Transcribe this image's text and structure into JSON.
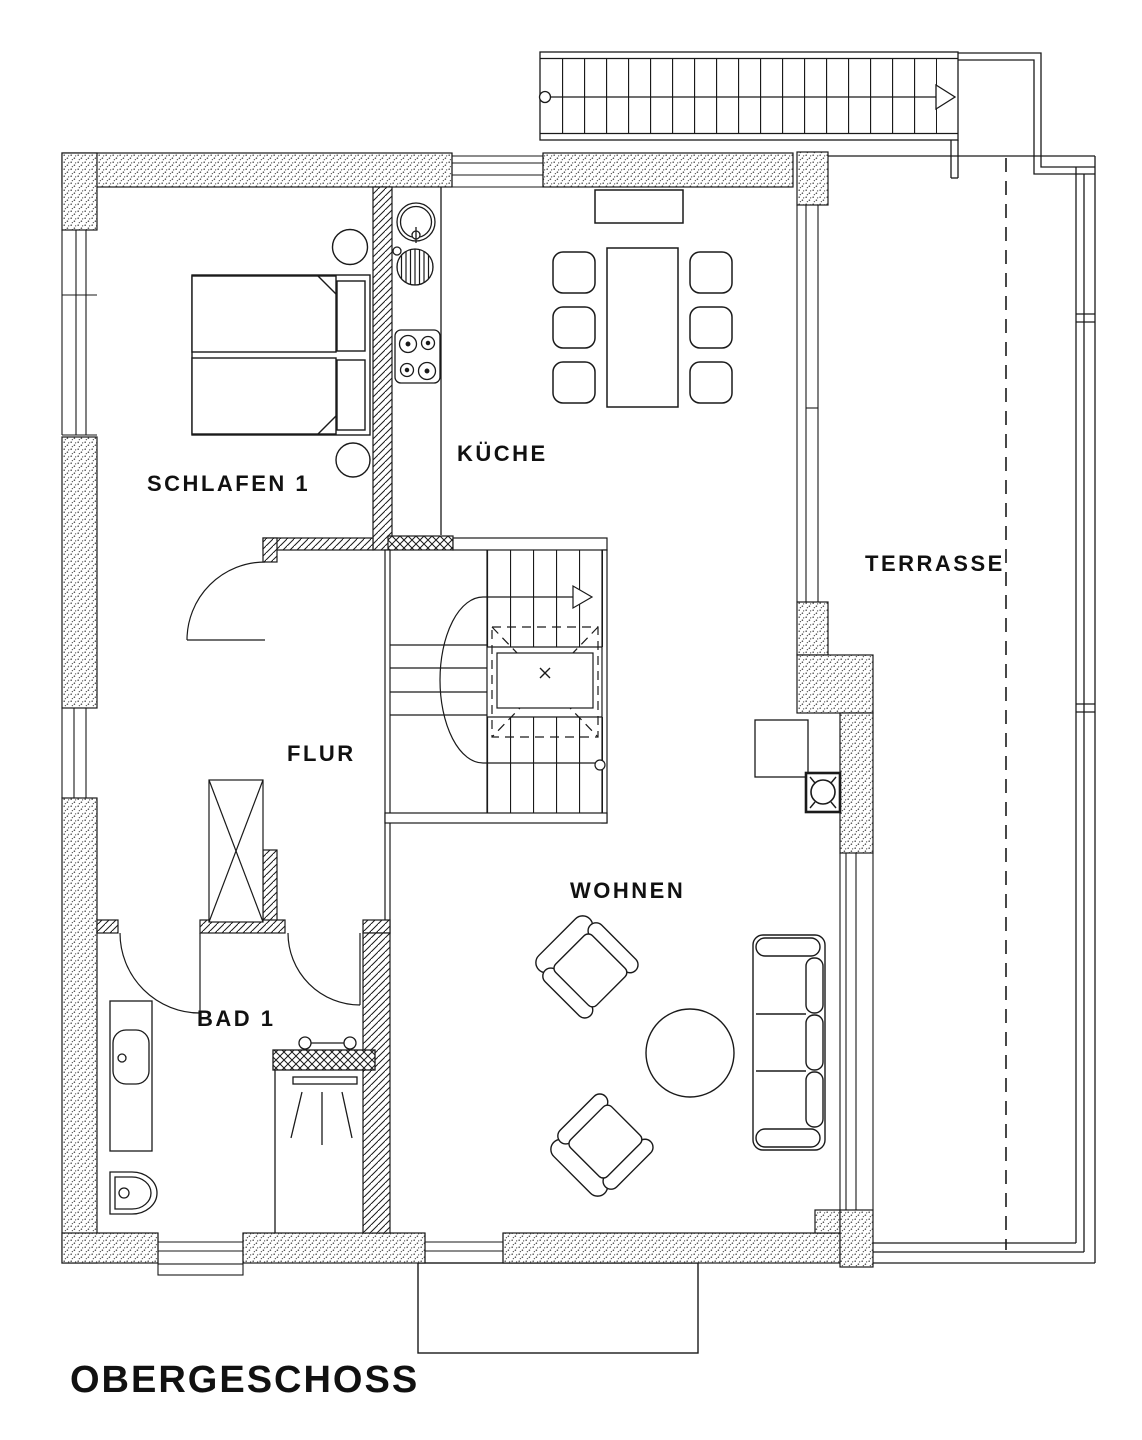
{
  "plan": {
    "floor_title": "OBERGESCHOSS",
    "rooms": [
      {
        "id": "schlafen-1",
        "label": "SCHLAFEN 1"
      },
      {
        "id": "kueche",
        "label": "KÜCHE"
      },
      {
        "id": "terrasse",
        "label": "TERRASSE"
      },
      {
        "id": "flur",
        "label": "FLUR"
      },
      {
        "id": "wohnen",
        "label": "WOHNEN"
      },
      {
        "id": "bad-1",
        "label": "BAD 1"
      }
    ],
    "colors": {
      "line": "#1a1a1a",
      "background": "#ffffff"
    }
  }
}
